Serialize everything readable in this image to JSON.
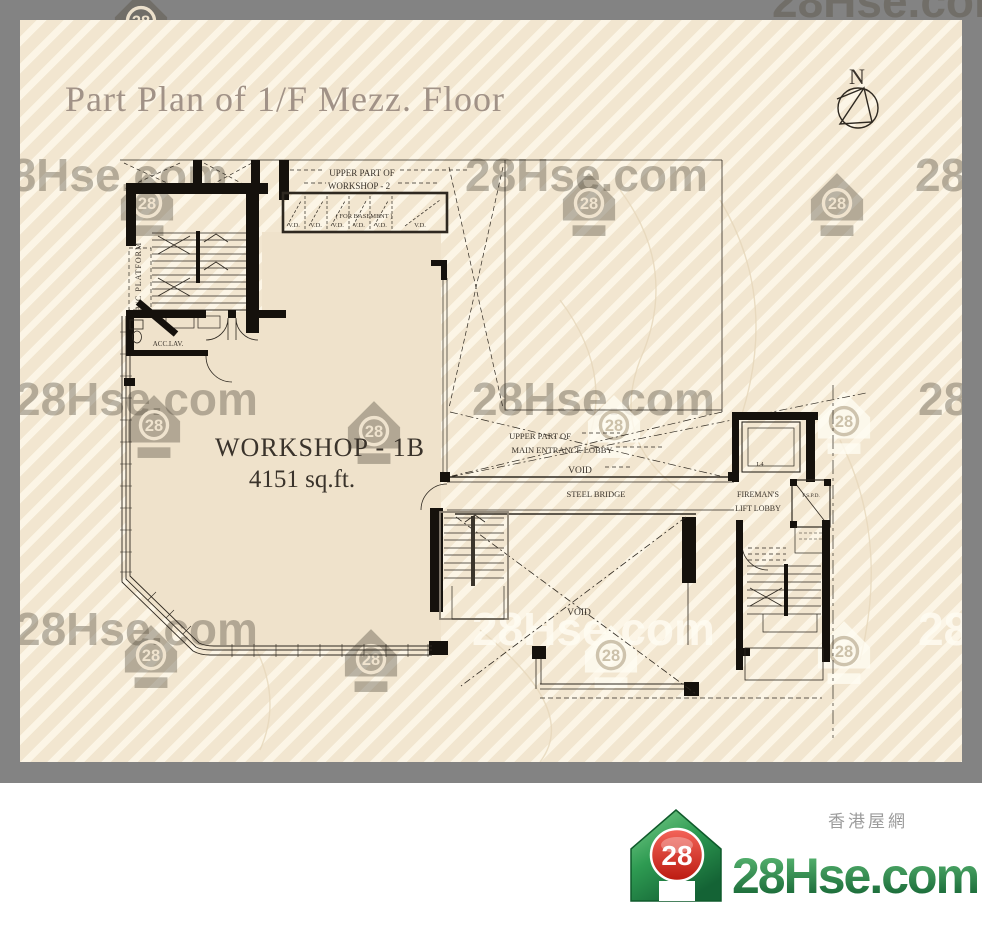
{
  "frame": {
    "title": "Part Plan of 1/F Mezz. Floor"
  },
  "compass": {
    "label": "N"
  },
  "watermark": {
    "text": "28Hse.com",
    "icon_number": "28"
  },
  "plan": {
    "workshop": {
      "name": "WORKSHOP - 1B",
      "area": "4151 sq.ft."
    },
    "labels": {
      "upper_workshop2_l1": "UPPER PART OF",
      "upper_workshop2_l2": "WORKSHOP - 2",
      "for_basement": "( FOR  BASEMENT )",
      "vd": "V.D.",
      "ac_platform": "A/C  PLATFORM",
      "acc_lav": "ACC.LAV.",
      "upper_lobby_l1": "UPPER PART OF",
      "upper_lobby_l2": "MAIN ENTRANCE LOBBY",
      "void_upper": "VOID",
      "steel_bridge": "STEEL BRIDGE",
      "fireman_l1": "FIREMAN'S",
      "fireman_l2": "LIFT LOBBY",
      "lift_l4": "L4",
      "fspd": "F.S.P.D.",
      "void_lower": "VOID"
    }
  },
  "footer": {
    "title": "江博士中心 Dr. Kong Centre",
    "address": "青山道550號",
    "floor": "江博士中心 1樓閣樓"
  },
  "logo": {
    "badge": "28",
    "site": "28Hse.com",
    "site_cn": "香港屋網"
  },
  "colors": {
    "accent_green": "#1D5B38",
    "logo_red": "#D62B23",
    "frame_gray": "#838383",
    "paper": "#F2E6D0"
  }
}
